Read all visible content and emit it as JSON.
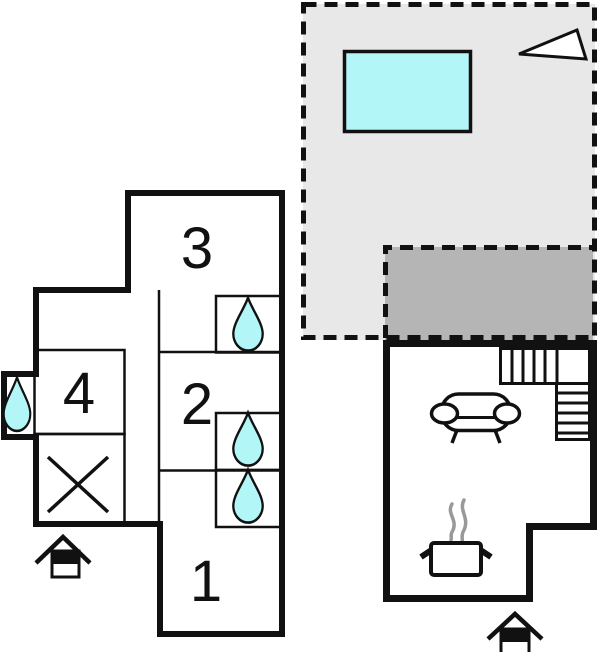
{
  "plan": {
    "title": "vacation-home-floor-plan"
  },
  "rooms": [
    {
      "id": "room-1",
      "number": "1"
    },
    {
      "id": "room-2",
      "number": "2"
    },
    {
      "id": "room-3",
      "number": "3"
    },
    {
      "id": "room-4",
      "number": "4"
    }
  ],
  "icons": {
    "pool": "pool-icon",
    "north_arrow": "north-arrow-icon",
    "water_drop": "water-drop-icon",
    "no_access": "no-access-cross-icon",
    "sofa": "sofa-icon",
    "stairs": "stairs-icon",
    "cooking_pot": "cooking-pot-icon",
    "steam": "steam-icon",
    "entrance": "entrance-house-icon"
  },
  "colors": {
    "wall": "#111111",
    "terrace": "#e8e8e8",
    "patio": "#b5b5b5",
    "water": "#b2f6f8",
    "steam": "#999999",
    "white": "#ffffff"
  }
}
